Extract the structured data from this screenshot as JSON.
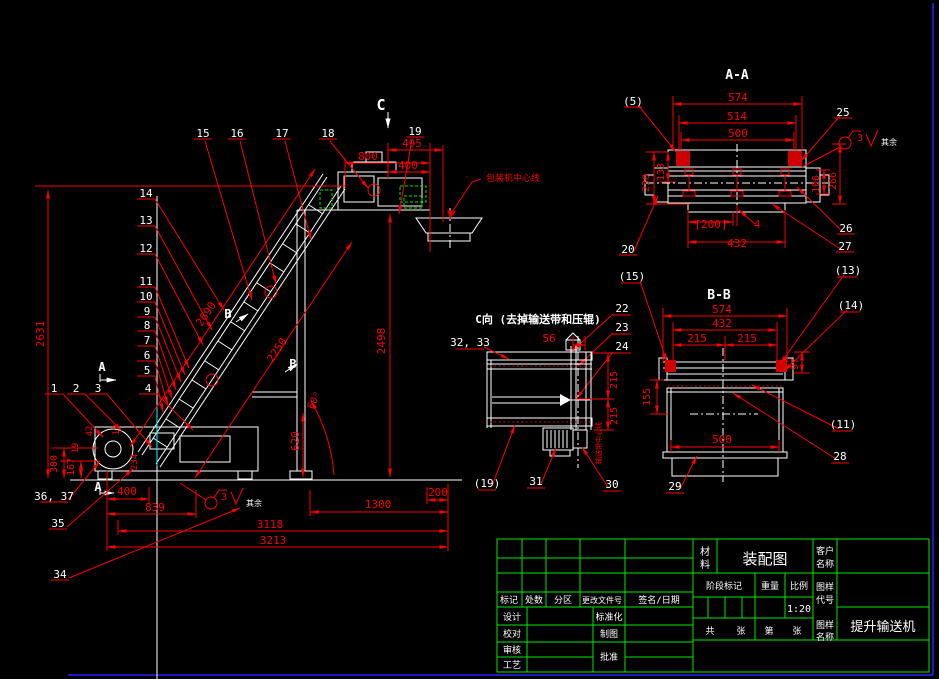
{
  "meta": {
    "type": "cad-assembly-drawing",
    "drawing_name": "提升输送机",
    "drawing_kind": "装配图",
    "scale": "1:20",
    "section_views": [
      "A-A",
      "B-B",
      "C向"
    ]
  },
  "colors": {
    "white": "#ffffff",
    "red": "#fa0000",
    "green": "#00e800",
    "blue": "#2222ff",
    "cyan": "#00ffff",
    "background": "#000000"
  },
  "annotations": [
    {
      "name": "section-marker-c",
      "t": "C",
      "x": 381,
      "y": 110,
      "c": "white",
      "s": 15,
      "b": 1
    },
    {
      "name": "part-label-15",
      "t": "15",
      "x": 203,
      "y": 137,
      "c": "white",
      "s": 11
    },
    {
      "name": "part-label-16",
      "t": "16",
      "x": 237,
      "y": 137,
      "c": "white",
      "s": 11
    },
    {
      "name": "part-label-17",
      "t": "17",
      "x": 282,
      "y": 137,
      "c": "white",
      "s": 11
    },
    {
      "name": "part-label-18",
      "t": "18",
      "x": 328,
      "y": 137,
      "c": "white",
      "s": 11
    },
    {
      "name": "part-label-19",
      "t": "19",
      "x": 415,
      "y": 135,
      "c": "white",
      "s": 11
    },
    {
      "name": "part-label-14",
      "t": "14",
      "x": 146,
      "y": 197,
      "c": "white",
      "s": 11
    },
    {
      "name": "part-label-13",
      "t": "13",
      "x": 146,
      "y": 224,
      "c": "white",
      "s": 11
    },
    {
      "name": "part-label-12",
      "t": "12",
      "x": 146,
      "y": 252,
      "c": "white",
      "s": 11
    },
    {
      "name": "part-label-11",
      "t": "11",
      "x": 146,
      "y": 285,
      "c": "white",
      "s": 11
    },
    {
      "name": "part-label-10",
      "t": "10",
      "x": 146,
      "y": 300,
      "c": "white",
      "s": 11
    },
    {
      "name": "part-label-9",
      "t": "9",
      "x": 147,
      "y": 315,
      "c": "white",
      "s": 11
    },
    {
      "name": "part-label-8",
      "t": "8",
      "x": 147,
      "y": 329,
      "c": "white",
      "s": 11
    },
    {
      "name": "part-label-7",
      "t": "7",
      "x": 147,
      "y": 344,
      "c": "white",
      "s": 11
    },
    {
      "name": "part-label-6",
      "t": "6",
      "x": 147,
      "y": 359,
      "c": "white",
      "s": 11
    },
    {
      "name": "part-label-5",
      "t": "5",
      "x": 147,
      "y": 374,
      "c": "white",
      "s": 11
    },
    {
      "name": "part-label-1",
      "t": "1",
      "x": 54,
      "y": 392,
      "c": "white",
      "s": 11
    },
    {
      "name": "part-label-2",
      "t": "2",
      "x": 76,
      "y": 392,
      "c": "white",
      "s": 11
    },
    {
      "name": "part-label-3",
      "t": "3",
      "x": 98,
      "y": 392,
      "c": "white",
      "s": 11
    },
    {
      "name": "part-label-4",
      "t": "4",
      "x": 148,
      "y": 392,
      "c": "white",
      "s": 11
    },
    {
      "name": "part-label-36-37",
      "t": "36, 37",
      "x": 54,
      "y": 500,
      "c": "white",
      "s": 11
    },
    {
      "name": "part-label-35",
      "t": "35",
      "x": 58,
      "y": 527,
      "c": "white",
      "s": 11
    },
    {
      "name": "part-label-34",
      "t": "34",
      "x": 60,
      "y": 578,
      "c": "white",
      "s": 11
    },
    {
      "name": "section-marker-a-upper",
      "t": "A",
      "x": 102,
      "y": 371,
      "c": "white",
      "s": 12,
      "b": 1
    },
    {
      "name": "section-marker-a-lower",
      "t": "A",
      "x": 98,
      "y": 491,
      "c": "white",
      "s": 12,
      "b": 1
    },
    {
      "name": "section-marker-b-upper",
      "t": "B",
      "x": 228,
      "y": 318,
      "c": "white",
      "s": 12,
      "b": 1
    },
    {
      "name": "section-marker-b-lower",
      "t": "B",
      "x": 293,
      "y": 368,
      "c": "white",
      "s": 12,
      "b": 1
    },
    {
      "name": "dim-800",
      "t": "800",
      "x": 368,
      "y": 160,
      "c": "red",
      "s": 11
    },
    {
      "name": "dim-495",
      "t": "495",
      "x": 412,
      "y": 147,
      "c": "red",
      "s": 11
    },
    {
      "name": "dim-400-top",
      "t": "400",
      "x": 408,
      "y": 169,
      "c": "red",
      "s": 11
    },
    {
      "name": "dim-2631",
      "t": "2631",
      "x": 44,
      "y": 334,
      "c": "red",
      "s": 11,
      "rot": -90
    },
    {
      "name": "dim-2690",
      "t": "2690",
      "x": 209,
      "y": 316,
      "c": "red",
      "s": 11,
      "rot": -56
    },
    {
      "name": "dim-2250",
      "t": "2250",
      "x": 280,
      "y": 352,
      "c": "red",
      "s": 11,
      "rot": -56
    },
    {
      "name": "dim-2498",
      "t": "2498",
      "x": 385,
      "y": 341,
      "c": "red",
      "s": 11,
      "rot": -90
    },
    {
      "name": "dim-620",
      "t": "620",
      "x": 299,
      "y": 441,
      "c": "red",
      "s": 11,
      "rot": -90
    },
    {
      "name": "dim-60deg",
      "t": "60°",
      "x": 317,
      "y": 402,
      "c": "red",
      "s": 10,
      "rot": -60
    },
    {
      "name": "dim-42",
      "t": "42",
      "x": 92,
      "y": 431,
      "c": "red",
      "s": 9,
      "rot": -90
    },
    {
      "name": "dim-13",
      "t": "13",
      "x": 119,
      "y": 430,
      "c": "red",
      "s": 9,
      "rot": -90
    },
    {
      "name": "dim-234",
      "t": "234",
      "x": 137,
      "y": 462,
      "c": "red",
      "s": 9,
      "rot": -90
    },
    {
      "name": "dim-19",
      "t": "19",
      "x": 78,
      "y": 448,
      "c": "red",
      "s": 9,
      "rot": -90
    },
    {
      "name": "dim-300",
      "t": "300",
      "x": 57,
      "y": 464,
      "c": "red",
      "s": 10,
      "rot": -90
    },
    {
      "name": "dim-167",
      "t": "167",
      "x": 74,
      "y": 467,
      "c": "red",
      "s": 10,
      "rot": -90
    },
    {
      "name": "dim-400-bottom",
      "t": "400",
      "x": 127,
      "y": 495,
      "c": "red",
      "s": 11
    },
    {
      "name": "dim-839",
      "t": "839",
      "x": 155,
      "y": 511,
      "c": "red",
      "s": 11
    },
    {
      "name": "dim-1300",
      "t": "1300",
      "x": 378,
      "y": 508,
      "c": "red",
      "s": 11
    },
    {
      "name": "dim-200",
      "t": "200",
      "x": 438,
      "y": 496,
      "c": "red",
      "s": 11
    },
    {
      "name": "dim-3118",
      "t": "3118",
      "x": 270,
      "y": 528,
      "c": "red",
      "s": 11
    },
    {
      "name": "dim-3213",
      "t": "3213",
      "x": 273,
      "y": 544,
      "c": "red",
      "s": 11
    },
    {
      "name": "note-packer-centerline",
      "t": "包装机中心线",
      "x": 513,
      "y": 181,
      "c": "red",
      "s": 9
    },
    {
      "name": "roughness-main-value",
      "t": "3",
      "x": 224,
      "y": 500,
      "c": "red",
      "s": 10
    },
    {
      "name": "roughness-main-rest",
      "t": "其余",
      "x": 254,
      "y": 506,
      "c": "white",
      "s": 8
    },
    {
      "name": "view-title-aa",
      "t": "A-A",
      "x": 737,
      "y": 79,
      "c": "white",
      "s": 13,
      "b": 1
    },
    {
      "name": "aa-part-label-5",
      "t": "(5)",
      "x": 633,
      "y": 105,
      "c": "white",
      "s": 11
    },
    {
      "name": "aa-part-label-25",
      "t": "25",
      "x": 843,
      "y": 116,
      "c": "white",
      "s": 11
    },
    {
      "name": "aa-part-label-26",
      "t": "26",
      "x": 846,
      "y": 232,
      "c": "white",
      "s": 11
    },
    {
      "name": "aa-part-label-27",
      "t": "27",
      "x": 845,
      "y": 250,
      "c": "white",
      "s": 11
    },
    {
      "name": "aa-part-label-20",
      "t": "20",
      "x": 628,
      "y": 253,
      "c": "white",
      "s": 11
    },
    {
      "name": "aa-dim-574",
      "t": "574",
      "x": 738,
      "y": 101,
      "c": "red",
      "s": 11
    },
    {
      "name": "aa-dim-514",
      "t": "514",
      "x": 737,
      "y": 120,
      "c": "red",
      "s": 11
    },
    {
      "name": "aa-dim-500",
      "t": "500",
      "x": 738,
      "y": 137,
      "c": "red",
      "s": 11
    },
    {
      "name": "aa-dim-230",
      "t": "230",
      "x": 649,
      "y": 183,
      "c": "red",
      "s": 10,
      "rot": -90
    },
    {
      "name": "aa-dim-133",
      "t": "133",
      "x": 664,
      "y": 172,
      "c": "red",
      "s": 10,
      "rot": -90
    },
    {
      "name": "aa-dim-106",
      "t": "106",
      "x": 819,
      "y": 184,
      "c": "red",
      "s": 10,
      "rot": -90
    },
    {
      "name": "aa-dim-266",
      "t": "266",
      "x": 836,
      "y": 181,
      "c": "red",
      "s": 10,
      "rot": -90
    },
    {
      "name": "aa-dim-200",
      "t": "[200]",
      "x": 711,
      "y": 228,
      "c": "red",
      "s": 11
    },
    {
      "name": "aa-dim-4",
      "t": "4",
      "x": 757,
      "y": 228,
      "c": "red",
      "s": 11
    },
    {
      "name": "aa-dim-432",
      "t": "432",
      "x": 737,
      "y": 247,
      "c": "red",
      "s": 11
    },
    {
      "name": "roughness-aa-value",
      "t": "3",
      "x": 860,
      "y": 141,
      "c": "red",
      "s": 10
    },
    {
      "name": "roughness-aa-rest",
      "t": "其余",
      "x": 889,
      "y": 145,
      "c": "white",
      "s": 8
    },
    {
      "name": "view-title-bb",
      "t": "B-B",
      "x": 719,
      "y": 299,
      "c": "white",
      "s": 13,
      "b": 1
    },
    {
      "name": "bb-part-label-15",
      "t": "(15)",
      "x": 632,
      "y": 280,
      "c": "white",
      "s": 11
    },
    {
      "name": "bb-part-label-13",
      "t": "(13)",
      "x": 848,
      "y": 274,
      "c": "white",
      "s": 11
    },
    {
      "name": "bb-part-label-14",
      "t": "(14)",
      "x": 851,
      "y": 309,
      "c": "white",
      "s": 11
    },
    {
      "name": "bb-part-label-11",
      "t": "(11)",
      "x": 843,
      "y": 428,
      "c": "white",
      "s": 11
    },
    {
      "name": "bb-part-label-28",
      "t": "28",
      "x": 840,
      "y": 460,
      "c": "white",
      "s": 11
    },
    {
      "name": "bb-part-label-29",
      "t": "29",
      "x": 675,
      "y": 490,
      "c": "white",
      "s": 11
    },
    {
      "name": "c-part-label-22",
      "t": "22",
      "x": 622,
      "y": 312,
      "c": "white",
      "s": 11
    },
    {
      "name": "c-part-label-23",
      "t": "23",
      "x": 622,
      "y": 331,
      "c": "white",
      "s": 11
    },
    {
      "name": "c-part-label-24",
      "t": "24",
      "x": 622,
      "y": 350,
      "c": "white",
      "s": 11
    },
    {
      "name": "bb-dim-574",
      "t": "574",
      "x": 722,
      "y": 313,
      "c": "red",
      "s": 11
    },
    {
      "name": "bb-dim-432",
      "t": "432",
      "x": 722,
      "y": 327,
      "c": "red",
      "s": 11
    },
    {
      "name": "bb-dim-215-left",
      "t": "215",
      "x": 697,
      "y": 342,
      "c": "red",
      "s": 11
    },
    {
      "name": "bb-dim-215-right",
      "t": "215",
      "x": 747,
      "y": 342,
      "c": "red",
      "s": 11
    },
    {
      "name": "bb-dim-155",
      "t": "155",
      "x": 650,
      "y": 397,
      "c": "red",
      "s": 10,
      "rot": -90
    },
    {
      "name": "bb-dim-97",
      "t": "97",
      "x": 798,
      "y": 364,
      "c": "red",
      "s": 10,
      "rot": -90
    },
    {
      "name": "bb-dim-500",
      "t": "500",
      "x": 722,
      "y": 443,
      "c": "red",
      "s": 11
    },
    {
      "name": "view-title-c",
      "t": "C向 (去掉输送带和压辊)",
      "x": 538,
      "y": 323,
      "c": "white",
      "s": 11,
      "b": 1
    },
    {
      "name": "c-part-label-32-33",
      "t": "32, 33",
      "x": 470,
      "y": 346,
      "c": "white",
      "s": 11
    },
    {
      "name": "c-part-label-19",
      "t": "(19)",
      "x": 487,
      "y": 487,
      "c": "white",
      "s": 11
    },
    {
      "name": "c-part-label-31",
      "t": "31",
      "x": 536,
      "y": 485,
      "c": "white",
      "s": 11
    },
    {
      "name": "c-part-label-30",
      "t": "30",
      "x": 612,
      "y": 488,
      "c": "white",
      "s": 11
    },
    {
      "name": "c-dim-56",
      "t": "56",
      "x": 549,
      "y": 342,
      "c": "red",
      "s": 11
    },
    {
      "name": "c-dim-215-upper",
      "t": "215",
      "x": 617,
      "y": 380,
      "c": "red",
      "s": 10,
      "rot": -90
    },
    {
      "name": "c-dim-215-lower",
      "t": "215",
      "x": 617,
      "y": 416,
      "c": "red",
      "s": 10,
      "rot": -90
    },
    {
      "name": "c-note-centerline",
      "t": "输送带中心线",
      "x": 601,
      "y": 443,
      "c": "red",
      "s": 7,
      "rot": -90
    },
    {
      "name": "tb-label-biaoji",
      "t": "标记",
      "x": 509,
      "y": 603,
      "c": "white",
      "s": 9
    },
    {
      "name": "tb-label-chushu",
      "t": "处数",
      "x": 534,
      "y": 603,
      "c": "white",
      "s": 9
    },
    {
      "name": "tb-label-fenqu",
      "t": "分区",
      "x": 563,
      "y": 603,
      "c": "white",
      "s": 9
    },
    {
      "name": "tb-label-genggaiwenjianhao",
      "t": "更改文件号",
      "x": 602,
      "y": 603,
      "c": "white",
      "s": 8
    },
    {
      "name": "tb-label-qianming-riqi",
      "t": "签名/日期",
      "x": 659,
      "y": 603,
      "c": "white",
      "s": 9
    },
    {
      "name": "tb-label-sheji",
      "t": "设计",
      "x": 512,
      "y": 620,
      "c": "white",
      "s": 9
    },
    {
      "name": "tb-label-biaozhunhua",
      "t": "标准化",
      "x": 609,
      "y": 620,
      "c": "white",
      "s": 9
    },
    {
      "name": "tb-label-jiaodui",
      "t": "校对",
      "x": 512,
      "y": 637,
      "c": "white",
      "s": 9
    },
    {
      "name": "tb-label-zhitu",
      "t": "制图",
      "x": 609,
      "y": 637,
      "c": "white",
      "s": 9
    },
    {
      "name": "tb-label-shenhe",
      "t": "审核",
      "x": 512,
      "y": 653,
      "c": "white",
      "s": 9
    },
    {
      "name": "tb-label-pizhun",
      "t": "批准",
      "x": 609,
      "y": 660,
      "c": "white",
      "s": 9
    },
    {
      "name": "tb-label-gongyi",
      "t": "工艺",
      "x": 512,
      "y": 668,
      "c": "white",
      "s": 9
    },
    {
      "name": "tb-label-cailiao-1",
      "t": "材",
      "x": 705,
      "y": 555,
      "c": "white",
      "s": 10
    },
    {
      "name": "tb-label-cailiao-2",
      "t": "料",
      "x": 705,
      "y": 568,
      "c": "white",
      "s": 10
    },
    {
      "name": "tb-value-zhuangpeitu",
      "t": "装配图",
      "x": 765,
      "y": 564,
      "c": "white",
      "s": 15
    },
    {
      "name": "tb-label-kehu-1",
      "t": "客户",
      "x": 825,
      "y": 554,
      "c": "white",
      "s": 9
    },
    {
      "name": "tb-label-kehu-2",
      "t": "名称",
      "x": 825,
      "y": 567,
      "c": "white",
      "s": 9
    },
    {
      "name": "tb-label-jieduanbiaoji",
      "t": "阶段标记",
      "x": 724,
      "y": 589,
      "c": "white",
      "s": 9
    },
    {
      "name": "tb-label-zhongliang",
      "t": "重量",
      "x": 770,
      "y": 589,
      "c": "white",
      "s": 9
    },
    {
      "name": "tb-label-bili",
      "t": "比例",
      "x": 799,
      "y": 589,
      "c": "white",
      "s": 9
    },
    {
      "name": "tb-label-tuyangdaihao-1",
      "t": "图样",
      "x": 825,
      "y": 590,
      "c": "white",
      "s": 9
    },
    {
      "name": "tb-label-tuyangdaihao-2",
      "t": "代号",
      "x": 825,
      "y": 603,
      "c": "white",
      "s": 9
    },
    {
      "name": "tb-value-scale",
      "t": "1:20",
      "x": 799,
      "y": 612,
      "c": "white",
      "s": 10
    },
    {
      "name": "tb-label-gong",
      "t": "共",
      "x": 710,
      "y": 634,
      "c": "white",
      "s": 9
    },
    {
      "name": "tb-label-zhang-1",
      "t": "张",
      "x": 741,
      "y": 634,
      "c": "white",
      "s": 9
    },
    {
      "name": "tb-label-di",
      "t": "第",
      "x": 769,
      "y": 634,
      "c": "white",
      "s": 9
    },
    {
      "name": "tb-label-zhang-2",
      "t": "张",
      "x": 797,
      "y": 634,
      "c": "white",
      "s": 9
    },
    {
      "name": "tb-label-tuyangmingcheng-1",
      "t": "图样",
      "x": 825,
      "y": 628,
      "c": "white",
      "s": 9
    },
    {
      "name": "tb-label-tuyangmingcheng-2",
      "t": "名称",
      "x": 825,
      "y": 640,
      "c": "white",
      "s": 9
    },
    {
      "name": "tb-value-drawing-name",
      "t": "提升输送机",
      "x": 883,
      "y": 631,
      "c": "white",
      "s": 13
    }
  ]
}
